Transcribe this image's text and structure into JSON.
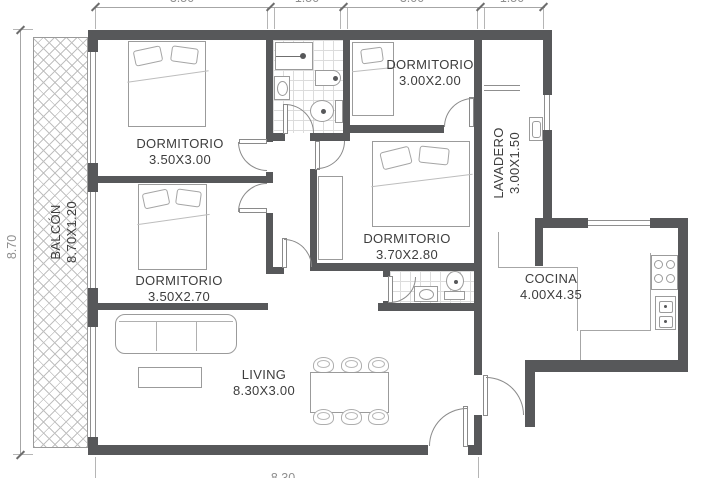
{
  "title": "apartment-floor-plan",
  "rooms": {
    "dorm1": {
      "name": "DORMITORIO",
      "size": "3.50X3.00"
    },
    "dorm2": {
      "name": "DORMITORIO",
      "size": "3.50X2.70"
    },
    "dorm3": {
      "name": "DORMITORIO",
      "size": "3.00X2.00"
    },
    "dorm4": {
      "name": "DORMITORIO",
      "size": "3.70X2.80"
    },
    "living": {
      "name": "LIVING",
      "size": "8.30X3.00"
    },
    "cocina": {
      "name": "COCINA",
      "size": "4.00X4.35"
    },
    "lavadero": {
      "name": "LAVADERO",
      "size": "3.00X1.50"
    },
    "balcon": {
      "name": "BALCÓN",
      "size": "8.70X1.20"
    }
  },
  "dimensions": {
    "top1": "3.50",
    "top2": "1.50",
    "top3": "3.00",
    "top4": "1.50",
    "left": "8.70",
    "bottom": "8.30"
  },
  "colors": {
    "wall": "#57585a",
    "line": "#8a8a8a",
    "text": "#3d3d3d",
    "dim": "#8f8f8f"
  }
}
